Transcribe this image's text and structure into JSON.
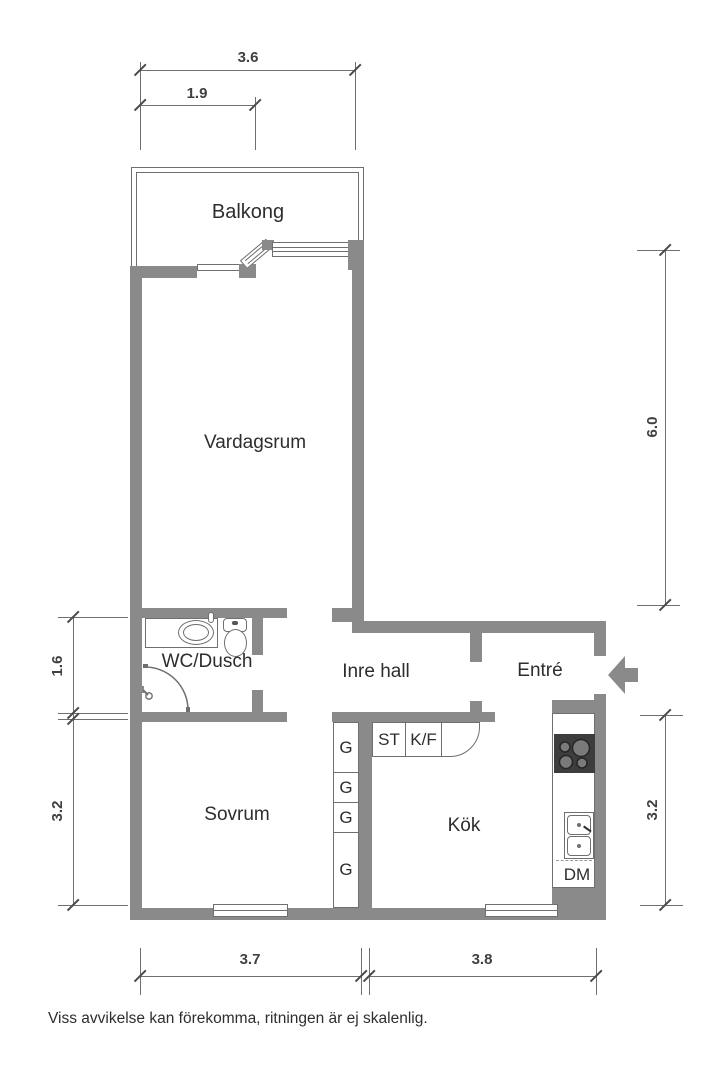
{
  "meta": {
    "footer": "Viss avvikelse kan förekomma, ritningen är ej skalenlig."
  },
  "colors": {
    "wall": "#8a8a8a",
    "line": "#6f6f6f",
    "text": "#2d2d2d",
    "stove": "#3d3d3d"
  },
  "rooms": {
    "balcony": "Balkong",
    "living": "Vardagsrum",
    "wc": "WC/Dusch",
    "hall": "Inre hall",
    "entrance": "Entré",
    "bedroom": "Sovrum",
    "kitchen": "Kök"
  },
  "fixtures": {
    "wardrobes": [
      "G",
      "G",
      "G",
      "G"
    ],
    "cabinets": [
      "ST",
      "K/F"
    ],
    "dishwasher": "DM"
  },
  "dimensions": {
    "top_outer": "3.6",
    "top_inner": "1.9",
    "left_upper": "1.6",
    "left_lower": "3.2",
    "right_upper": "6.0",
    "right_lower": "3.2",
    "bottom_left": "3.7",
    "bottom_right": "3.8"
  },
  "icons": [
    "entry-arrow-icon",
    "sink-icon",
    "toilet-icon",
    "shower-icon",
    "stove-icon",
    "kitchen-sink-icon"
  ]
}
